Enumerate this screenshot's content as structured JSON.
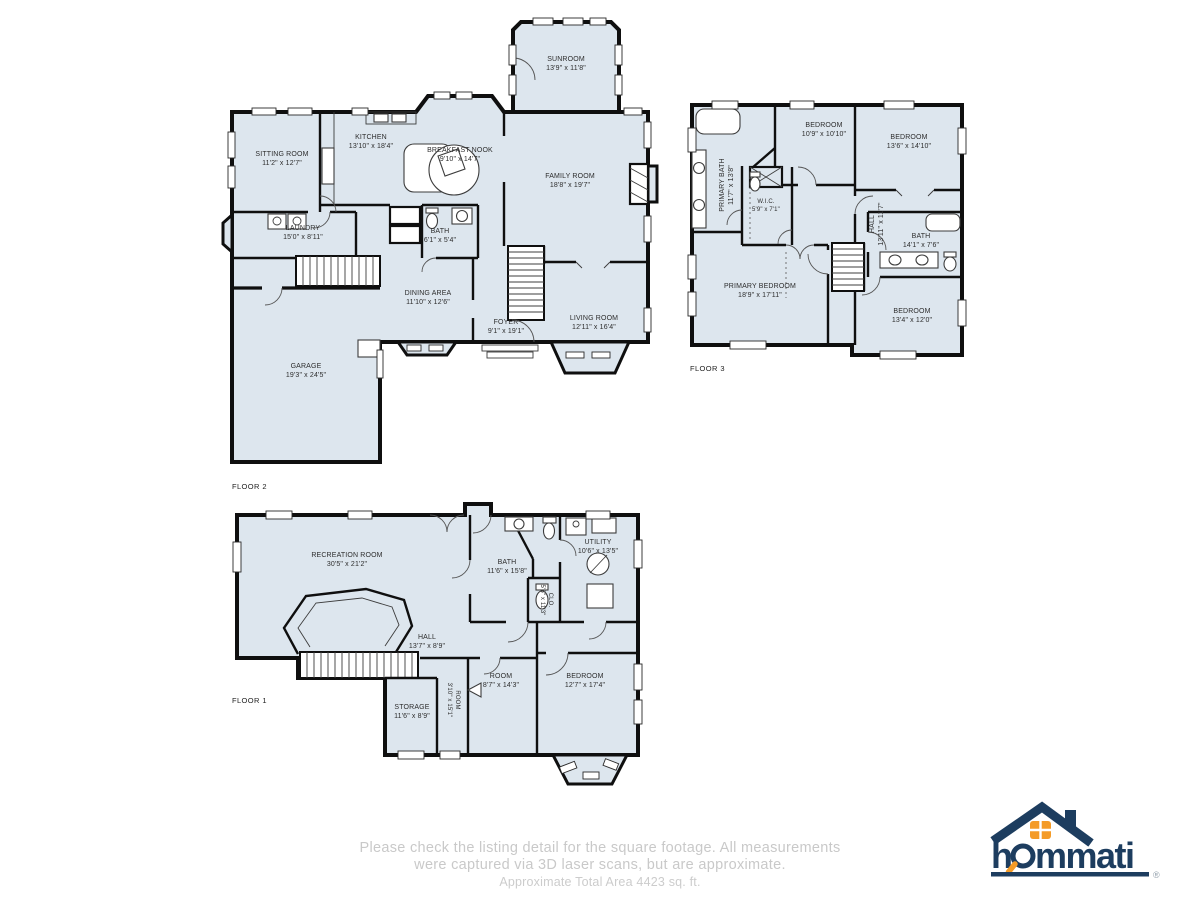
{
  "footer": {
    "line1": "Please check the listing detail for the square footage. All measurements",
    "line2": "were captured via 3D laser scans, but are approximate.",
    "line3": "Approximate Total Area 4423 sq. ft."
  },
  "logo": {
    "brand": "hommati",
    "brand_h": "h",
    "brand_rest": "mmati",
    "registered": "®",
    "navy": "#1d3d5f",
    "orange": "#f49b27"
  },
  "colors": {
    "room_fill": "#dde6ee",
    "wall": "#0f0f0f",
    "footer_text": "#c9c9c9"
  },
  "floors": [
    {
      "label": "FLOOR 2",
      "rooms": [
        {
          "name": "SUNROOM",
          "dims": "13'9\" x 11'8\""
        },
        {
          "name": "SITTING ROOM",
          "dims": "11'2\" x 12'7\""
        },
        {
          "name": "KITCHEN",
          "dims": "13'10\" x 18'4\""
        },
        {
          "name": "BREAKFAST NOOK",
          "dims": "9'10\" x 14'7\""
        },
        {
          "name": "FAMILY ROOM",
          "dims": "18'8\" x 19'7\""
        },
        {
          "name": "LAUNDRY",
          "dims": "15'0\" x 8'11\""
        },
        {
          "name": "BATH",
          "dims": "6'1\" x 5'4\""
        },
        {
          "name": "DINING AREA",
          "dims": "11'10\" x 12'6\""
        },
        {
          "name": "FOYER",
          "dims": "9'1\" x 19'1\""
        },
        {
          "name": "LIVING ROOM",
          "dims": "12'11\" x 16'4\""
        },
        {
          "name": "GARAGE",
          "dims": "19'3\" x 24'5\""
        }
      ]
    },
    {
      "label": "FLOOR 3",
      "rooms": [
        {
          "name": "PRIMARY BATH",
          "dims": "11'7\" x 13'8\""
        },
        {
          "name": "BEDROOM",
          "dims": "10'9\" x 10'10\""
        },
        {
          "name": "BEDROOM",
          "dims": "13'6\" x 14'10\""
        },
        {
          "name": "W.I.C.",
          "dims": "5'9\" x 7'1\""
        },
        {
          "name": "HALL",
          "dims": "13'11\" x 11'7\""
        },
        {
          "name": "BATH",
          "dims": "14'1\" x 7'6\""
        },
        {
          "name": "PRIMARY BEDROOM",
          "dims": "18'9\" x 17'11\""
        },
        {
          "name": "BEDROOM",
          "dims": "13'4\" x 12'0\""
        }
      ]
    },
    {
      "label": "FLOOR 1",
      "rooms": [
        {
          "name": "RECREATION ROOM",
          "dims": "30'5\" x 21'2\""
        },
        {
          "name": "BATH",
          "dims": "11'6\" x 15'8\""
        },
        {
          "name": "UTILITY",
          "dims": "10'6\" x 13'5\""
        },
        {
          "name": "CLO.",
          "dims": "5'6\" x 11'3\""
        },
        {
          "name": "HALL",
          "dims": "13'7\" x 8'9\""
        },
        {
          "name": "STORAGE",
          "dims": "11'6\" x 8'9\""
        },
        {
          "name": "ROOM",
          "dims": "3'10\" x 15'1\""
        },
        {
          "name": "ROOM",
          "dims": "8'7\" x 14'3\""
        },
        {
          "name": "BEDROOM",
          "dims": "12'7\" x 17'4\""
        }
      ]
    }
  ]
}
